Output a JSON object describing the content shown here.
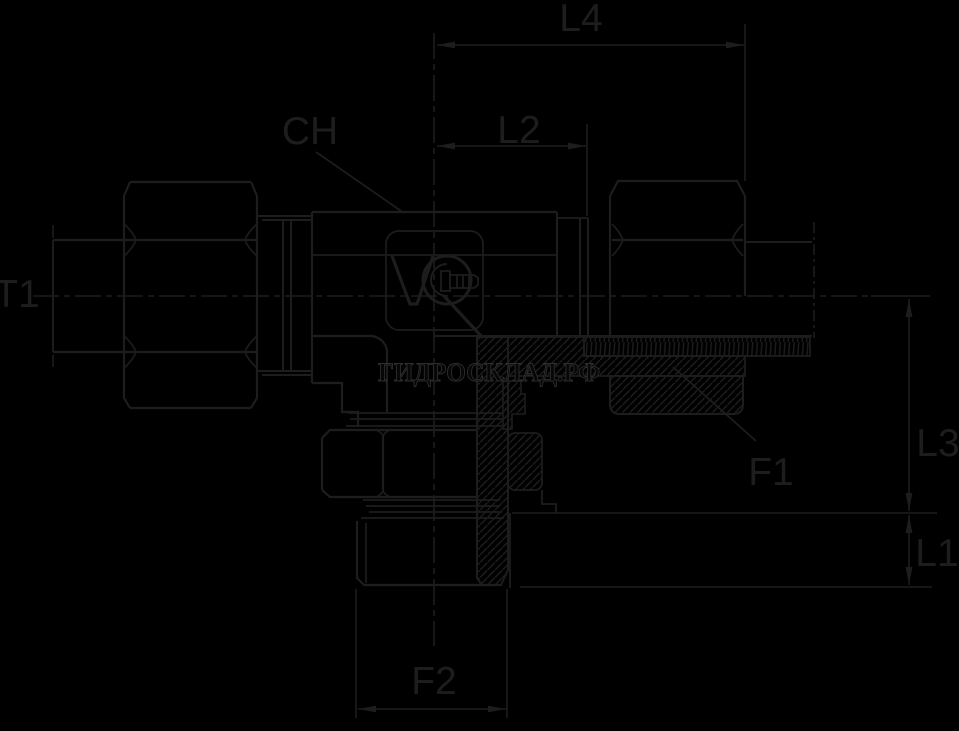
{
  "colors": {
    "background": "#000000",
    "line": "#1d1d1d",
    "watermark_fill": "#070707",
    "watermark_outline": "#2e2e2e"
  },
  "watermark": {
    "text": "ГИДРОСКЛАД.РФ"
  },
  "dimension_labels": {
    "l4": "L4",
    "l2": "L2",
    "ch": "CH",
    "t1": "T1",
    "f1": "F1",
    "l3": "L3",
    "l1": "L1",
    "f2": "F2"
  }
}
